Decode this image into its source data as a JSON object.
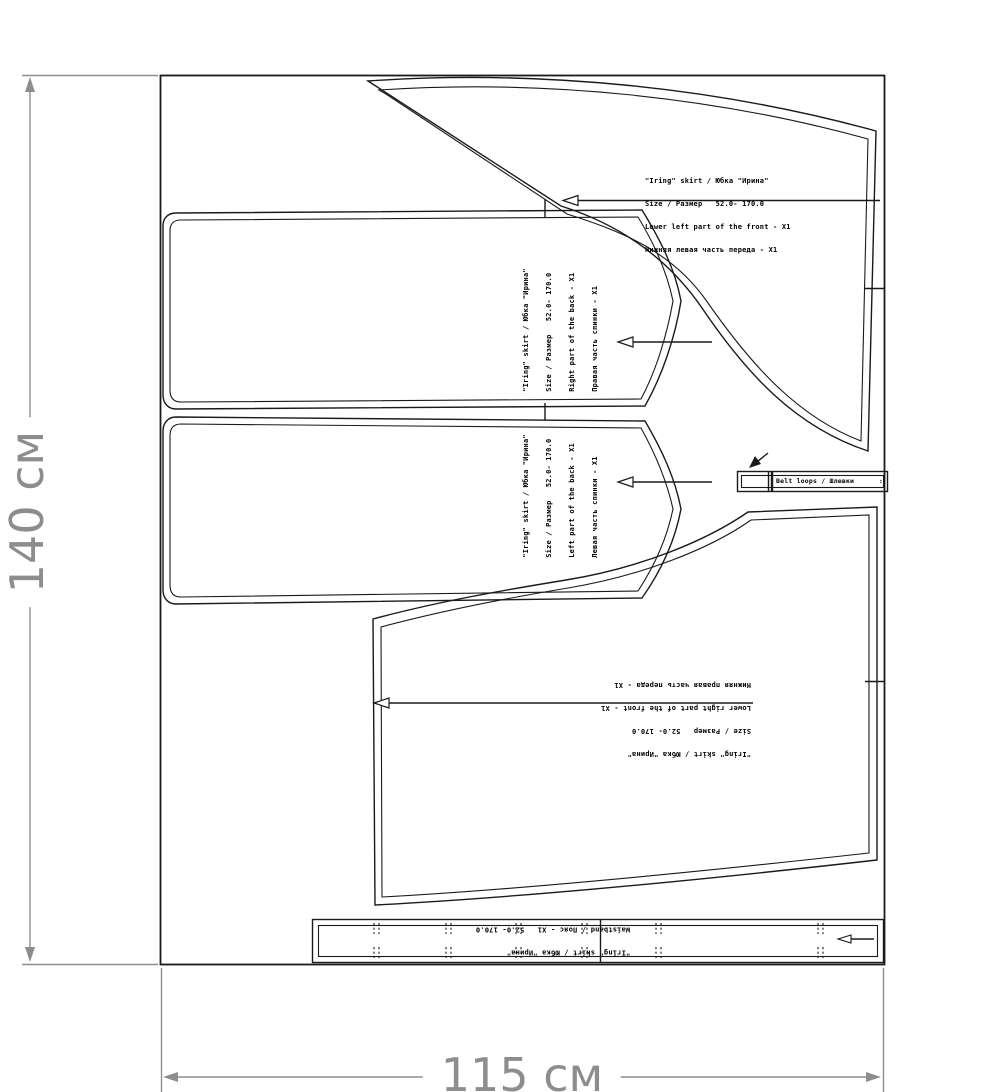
{
  "colors": {
    "background": "#ffffff",
    "pattern_line": "#1a1a1a",
    "dimension_gray": "#8d8d8d"
  },
  "dimensions": {
    "fabric_width_label": "115 см",
    "fabric_height_label": "140 см"
  },
  "pieces": {
    "lower_left_front": {
      "lines": [
        "\"Iring\" skirt / Юбка \"Ирина\"",
        "Size / Размер   52.0- 170.0",
        "Lower left part of the front - X1",
        "Нижняя левая часть переда - X1"
      ]
    },
    "back_right": {
      "lines": [
        "\"Iring\" skirt / Юбка \"Ирина\"",
        "Size / Размер   52.0- 170.0",
        "Right part of the back - X1",
        "Правая часть спинки - X1"
      ]
    },
    "back_left": {
      "lines": [
        "\"Iring\" skirt / Юбка \"Ирина\"",
        "Size / Размер   52.0- 170.0",
        "Left part of the back - X1",
        "Левая часть спинки - X1"
      ]
    },
    "lower_right_front": {
      "lines": [
        "\"Iring\" skirt / Юбка \"Ирина\"",
        "Size / Размер   52.0- 170.0",
        "Lower right part of the front - X1",
        "Нижняя правая часть переда - X1"
      ]
    },
    "waistband": {
      "lines": [
        "\"Iring\" skirt / Юбка \"Ирина\"",
        "Waistband / Пояс - X1   52.0- 170.0"
      ]
    },
    "belt_loops": {
      "label": "Belt loops / Шлевки      :"
    }
  }
}
